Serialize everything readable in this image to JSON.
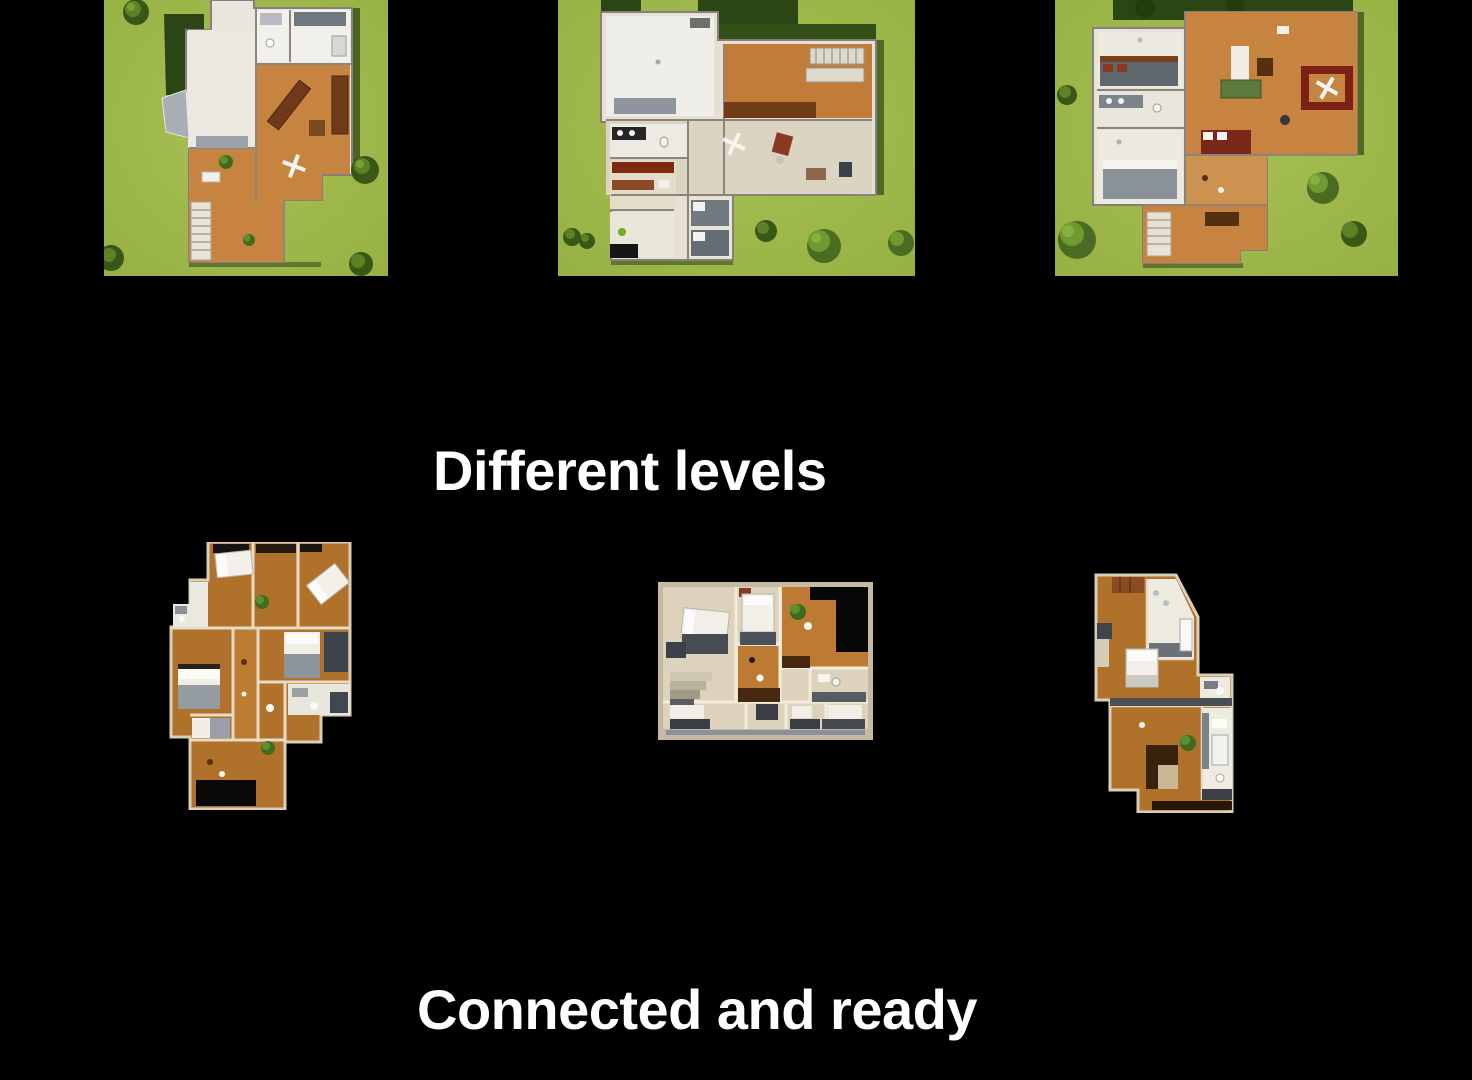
{
  "canvas": {
    "background": "#000000"
  },
  "captions": {
    "top": "Different levels",
    "bottom": "Connected and ready"
  },
  "palette": {
    "background": "#000000",
    "text": "#ffffff",
    "grass": "#9cb748",
    "grass_light": "#a7c156",
    "hedge_dark": "#2c4514",
    "tree_dark": "#3a5717",
    "tree_light": "#6f9a30",
    "wood_floor": "#c68440",
    "wood_floor_interior": "#b0712b",
    "wall_light": "#e6dcc6",
    "wall_outer": "#d9d0ba",
    "room_white": "#efeee8",
    "floor_beige": "#ddd3bd",
    "furniture_gray": "#6b7178",
    "furniture_dark": "#3c4046",
    "sofa_brown": "#6e3a19",
    "accent_red": "#8a3a22",
    "dark_floor": "#0b0908",
    "plant_green": "#4c7c28"
  },
  "floorplans": {
    "top_row": [
      {
        "name": "site-plan-level-1"
      },
      {
        "name": "site-plan-level-2"
      },
      {
        "name": "site-plan-level-3"
      }
    ],
    "bottom_row": [
      {
        "name": "interior-plan-1"
      },
      {
        "name": "interior-plan-2"
      },
      {
        "name": "interior-plan-3"
      }
    ]
  }
}
